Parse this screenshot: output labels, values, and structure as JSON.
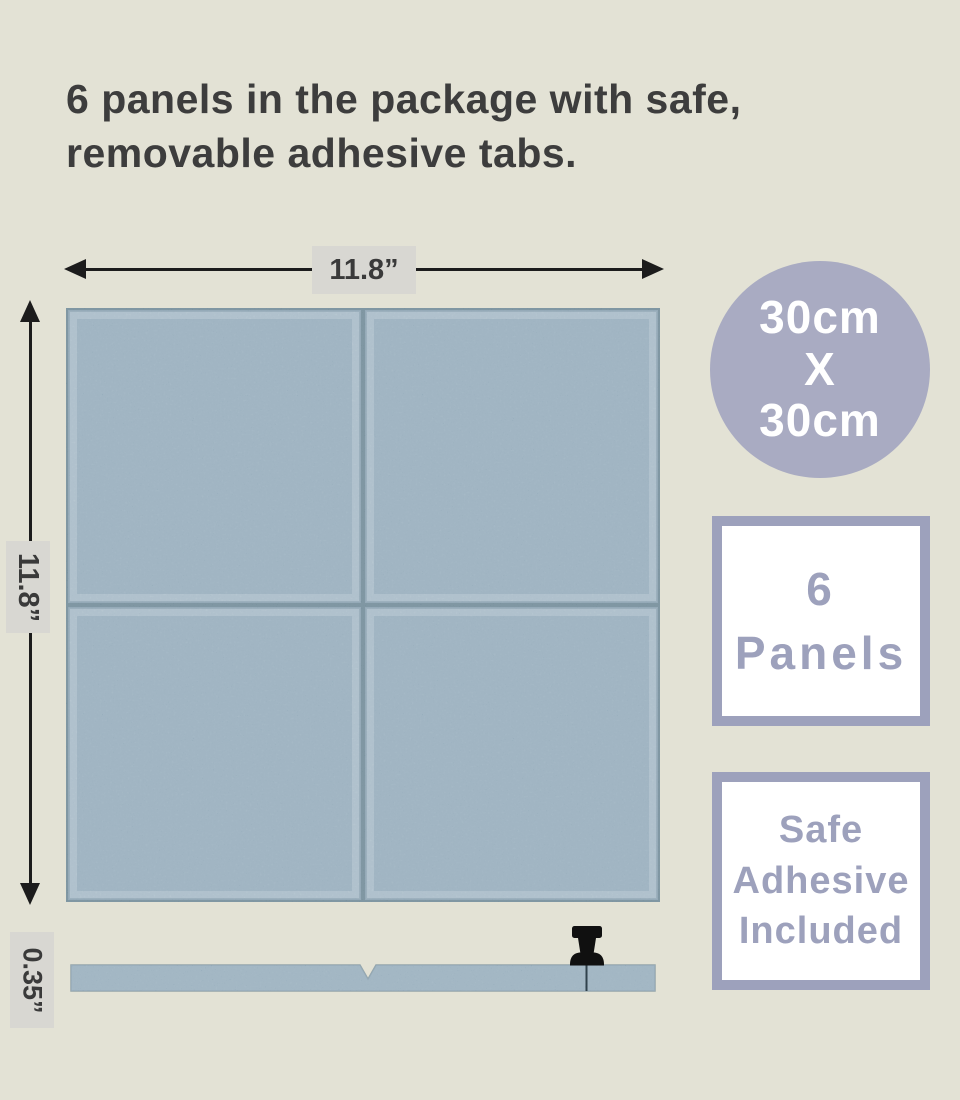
{
  "colors": {
    "bg": "#e3e2d5",
    "heading-text": "#3d3d3d",
    "dim-line": "#1c1c1c",
    "dim-label-bg": "#d8d7d2",
    "dim-text": "#3a3a3a",
    "panel": "#87a1b3",
    "panel-bevel": "#a9bdc9",
    "panel-seam": "#4c6a7a",
    "panel-edge": "#607d8f",
    "badge-circle-bg": "#a9abc2",
    "badge-text-color": "#ffffff",
    "box-border": "#9da1bc",
    "box-text": "#9da1bc",
    "pin-color": "#101010",
    "white": "#ffffff"
  },
  "heading": {
    "text": "6 panels in the package with safe,\nremovable adhesive tabs."
  },
  "dimensions": {
    "width_label": "11.8”",
    "height_label": "11.8”",
    "thickness_label": "0.35”"
  },
  "badges": {
    "size_circle": {
      "text": "30cm\nX\n30cm"
    },
    "panels_box": {
      "text": "6\nPanels"
    },
    "adhesive_box": {
      "text": "Safe\nAdhesive\nIncluded"
    }
  },
  "icons": {
    "pushpin": "black-thumbtack"
  }
}
